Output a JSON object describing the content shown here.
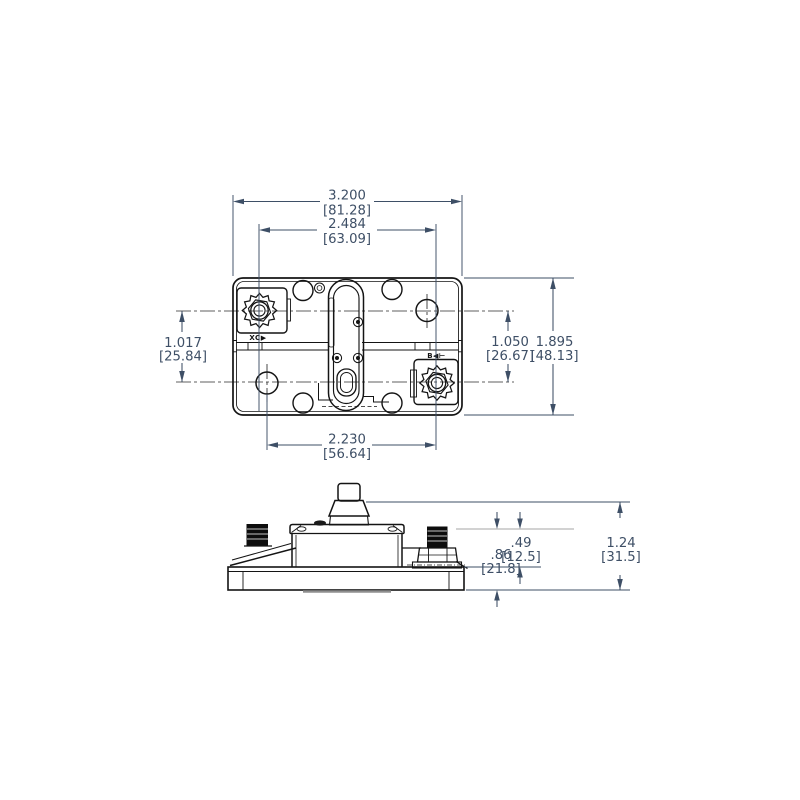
{
  "drawing": {
    "top_view": {
      "dims": {
        "overall_width": {
          "in": "3.200",
          "mm": "[81.28]"
        },
        "terminal_spacing": {
          "in": "2.484",
          "mm": "[63.09]"
        },
        "left_height": {
          "in": "1.017",
          "mm": "[25.84]"
        },
        "right_height": {
          "in": "1.050",
          "mm": "[26.67]"
        },
        "overall_height": {
          "in": "1.895",
          "mm": "[48.13]"
        },
        "bottom_spacing": {
          "in": "2.230",
          "mm": "[56.64]"
        }
      },
      "markings": {
        "aux_terminal": "XC▶",
        "bat_terminal": "B◀⊢"
      }
    },
    "side_view": {
      "dims": {
        "stud_height": {
          "in": ".49",
          "mm": "[12.5]"
        },
        "body_height": {
          "in": ".86",
          "mm": "[21.8]"
        },
        "overall_height": {
          "in": "1.24",
          "mm": "[31.5]"
        }
      }
    },
    "colors": {
      "dimension": "#3E4F66",
      "geometry": "#141414",
      "light_extension": "#b8b8b8",
      "shadow": "#8f8f8f",
      "background": "#ffffff"
    }
  }
}
